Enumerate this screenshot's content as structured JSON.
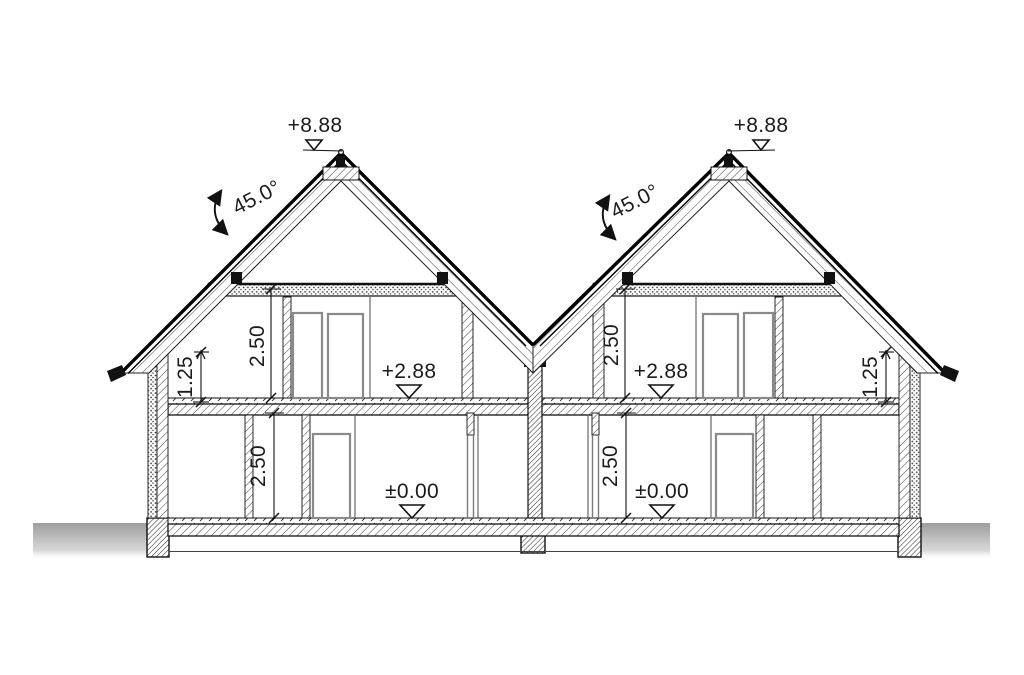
{
  "drawing": {
    "type": "architectural cross-section of twin-gable duplex house",
    "levels": {
      "ridge_left": "+8.88",
      "ridge_right": "+8.88",
      "first_floor_left": "+2.88",
      "first_floor_right": "+2.88",
      "ground_left": "±0.00",
      "ground_right": "±0.00"
    },
    "angles": {
      "roof_left": "45.0°",
      "roof_right": "45.0°"
    },
    "dimensions": {
      "upper_room_height_left": "2.50",
      "upper_room_height_right": "2.50",
      "knee_wall_left": "1.25",
      "knee_wall_right": "1.25",
      "ground_room_height_left": "2.50",
      "ground_room_height_right": "2.50"
    },
    "colors": {
      "line": "#1b1b1b",
      "door_outline": "#8a8a8a",
      "ground": "#a5a5a5",
      "paper": "#ffffff"
    }
  }
}
